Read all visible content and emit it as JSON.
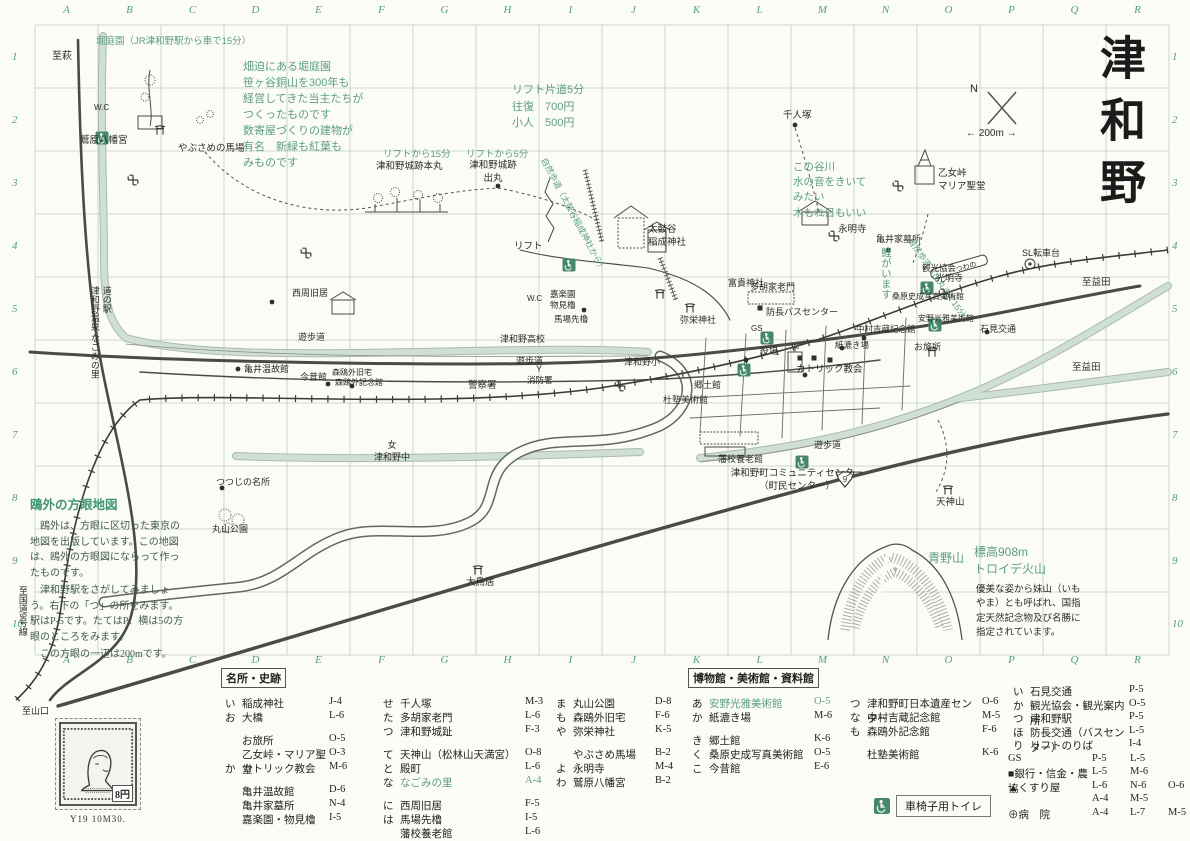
{
  "title": "津和野",
  "grid": {
    "columns": [
      "A",
      "B",
      "C",
      "D",
      "E",
      "F",
      "G",
      "H",
      "I",
      "J",
      "K",
      "L",
      "M",
      "N",
      "O",
      "P",
      "Q",
      "R"
    ],
    "rows": [
      "1",
      "2",
      "3",
      "4",
      "5",
      "6",
      "7",
      "8",
      "9",
      "10"
    ]
  },
  "colors": {
    "grid_green": "#53a07e",
    "annotation_green": "#5d9e7e",
    "river_green": "#cfe0d2",
    "ink": "#2b2b28"
  },
  "sidenote": {
    "title": "鴎外の方眼地図",
    "paragraphs": [
      "　鴎外は、方眼に区切った東京の地図を出版しています。この地図は、鴎外の方眼図にならって作ったものです。",
      "　津和野駅をさがしてみましょう。右下の「つ」の所をみます。駅はP-5です。たてはP、横は5の方眼のところをみます。",
      "　この方眼の一辺は200mです。"
    ]
  },
  "stamp": {
    "caption": "Y19 10M30.",
    "denomination": "8円"
  },
  "map": {
    "labels": [
      {
        "t": "至萩",
        "x": 52,
        "y": 50
      },
      {
        "t": "堀庭園（JR津和野駅から車で15分）",
        "x": 96,
        "y": 36,
        "c": "g",
        "s": 9.5
      },
      {
        "t": "畑迫にある堀庭園\n笹ヶ谷銅山を300年も\n経営してきた当主たちが\nつくったものです\n数寄屋づくりの建物が\n有名　新緑も紅葉も\nみものです",
        "x": 243,
        "y": 60,
        "c": "g",
        "s": 11,
        "lh": 1.45
      },
      {
        "t": "W.C",
        "x": 94,
        "y": 103,
        "s": 8
      },
      {
        "t": "鷲原八幡宮",
        "x": 80,
        "y": 135,
        "s": 9.5
      },
      {
        "t": "やぶさめの馬場",
        "x": 178,
        "y": 143,
        "s": 9.5
      },
      {
        "t": "リフトから15分",
        "x": 383,
        "y": 149,
        "c": "g",
        "s": 9.5
      },
      {
        "t": "津和野城跡本丸",
        "x": 376,
        "y": 161,
        "s": 9.5
      },
      {
        "t": "リフトから5分",
        "x": 466,
        "y": 149,
        "c": "g",
        "s": 9.5
      },
      {
        "t": "津和野城跡\n出丸",
        "x": 462,
        "y": 160,
        "s": 9.5,
        "w": 62
      },
      {
        "t": "リフト片道5分\n往復　700円\n小人　500円",
        "x": 512,
        "y": 82,
        "c": "g",
        "s": 11,
        "lh": 1.5
      },
      {
        "t": "自然歩道（太鼓谷稲成神社から）",
        "x": 548,
        "y": 156,
        "c": "g",
        "s": 8.5,
        "r": 62
      },
      {
        "t": "自然歩道（出丸まで15分）",
        "x": 914,
        "y": 236,
        "c": "g",
        "s": 8.5,
        "r": 55
      },
      {
        "t": "リフト",
        "x": 514,
        "y": 241,
        "s": 9.5
      },
      {
        "t": "太鼓谷\n稲成神社",
        "x": 648,
        "y": 224,
        "s": 9.5
      },
      {
        "t": "富貴神社",
        "x": 728,
        "y": 278,
        "s": 9
      },
      {
        "t": "多胡家老門",
        "x": 750,
        "y": 282,
        "s": 9
      },
      {
        "t": "千人塚",
        "x": 783,
        "y": 110,
        "s": 9.5
      },
      {
        "t": "この谷川\n水の音をきいて\nみたい\n木もれ日もいい",
        "x": 793,
        "y": 160,
        "c": "g",
        "s": 10.5,
        "lh": 1.45
      },
      {
        "t": "乙女峠\nマリア聖堂",
        "x": 938,
        "y": 168,
        "s": 9.5
      },
      {
        "t": "永明寺",
        "x": 838,
        "y": 224,
        "s": 9.5
      },
      {
        "t": "亀井家墓所",
        "x": 876,
        "y": 234,
        "s": 9
      },
      {
        "t": "光明寺",
        "x": 936,
        "y": 273,
        "s": 9
      },
      {
        "t": "SL転車台",
        "x": 1022,
        "y": 248,
        "s": 9
      },
      {
        "t": "至益田",
        "x": 1082,
        "y": 277,
        "s": 9.5
      },
      {
        "t": "至益田",
        "x": 1072,
        "y": 362,
        "s": 9.5
      },
      {
        "t": "N",
        "x": 970,
        "y": 82,
        "s": 11
      },
      {
        "t": "← 200m →",
        "x": 966,
        "y": 127,
        "s": 10
      },
      {
        "t": "観光協会",
        "x": 922,
        "y": 263,
        "s": 8.5
      },
      {
        "t": "桑原史成写真美術館",
        "x": 892,
        "y": 292,
        "s": 8
      },
      {
        "t": "安野光雅美術館",
        "x": 918,
        "y": 314,
        "s": 8
      },
      {
        "t": "石見交通",
        "x": 980,
        "y": 324,
        "s": 9
      },
      {
        "t": "お旅所",
        "x": 914,
        "y": 342,
        "s": 9
      },
      {
        "t": "防長バスセンター",
        "x": 766,
        "y": 307,
        "s": 9
      },
      {
        "t": "中村吉蔵記念館",
        "x": 856,
        "y": 324,
        "s": 8.5
      },
      {
        "t": "紙漉き場",
        "x": 835,
        "y": 340,
        "s": 8.5
      },
      {
        "t": "役場",
        "x": 760,
        "y": 346,
        "s": 9
      },
      {
        "t": "弥栄神社",
        "x": 680,
        "y": 315,
        "s": 9
      },
      {
        "t": "カトリック教会",
        "x": 796,
        "y": 364,
        "s": 9.5
      },
      {
        "t": "郷土館",
        "x": 694,
        "y": 380,
        "s": 9
      },
      {
        "t": "杜塾美術館",
        "x": 663,
        "y": 395,
        "s": 9
      },
      {
        "t": "津和野高校",
        "x": 500,
        "y": 334,
        "s": 9
      },
      {
        "t": "津和野小",
        "x": 624,
        "y": 357,
        "s": 9
      },
      {
        "t": "遊歩道",
        "x": 298,
        "y": 332,
        "s": 9
      },
      {
        "t": "遊歩道",
        "x": 516,
        "y": 356,
        "s": 9
      },
      {
        "t": "遊歩道",
        "x": 814,
        "y": 440,
        "s": 9
      },
      {
        "t": "西周旧居",
        "x": 292,
        "y": 288,
        "s": 9
      },
      {
        "t": "嘉楽園\n物見櫓",
        "x": 550,
        "y": 289,
        "s": 8.5
      },
      {
        "t": "馬場先櫓",
        "x": 554,
        "y": 314,
        "s": 8.5
      },
      {
        "t": "W.C",
        "x": 527,
        "y": 294,
        "s": 8
      },
      {
        "t": "亀井温故館",
        "x": 244,
        "y": 364,
        "s": 9
      },
      {
        "t": "今昔館",
        "x": 300,
        "y": 372,
        "s": 9
      },
      {
        "t": "森鴎外旧宅",
        "x": 332,
        "y": 368,
        "s": 8
      },
      {
        "t": "森鴎外記念館",
        "x": 335,
        "y": 378,
        "s": 8
      },
      {
        "t": "警察署",
        "x": 468,
        "y": 380,
        "s": 9.5
      },
      {
        "t": "Y",
        "x": 536,
        "y": 364,
        "s": 9
      },
      {
        "t": "消防署",
        "x": 527,
        "y": 375,
        "s": 8.5
      },
      {
        "t": "女\n津和野中",
        "x": 362,
        "y": 440,
        "s": 9,
        "w": 60
      },
      {
        "t": "津和野町コミュニティセンター\n（町民センター）",
        "x": 706,
        "y": 468,
        "s": 9.5,
        "w": 182
      },
      {
        "t": "藩校養老館",
        "x": 718,
        "y": 454,
        "s": 9
      },
      {
        "t": "天神山",
        "x": 936,
        "y": 497,
        "s": 9.5
      },
      {
        "t": "つつじの名所",
        "x": 216,
        "y": 477,
        "s": 9
      },
      {
        "t": "丸山公園",
        "x": 212,
        "y": 524,
        "s": 9
      },
      {
        "t": "大鳥居",
        "x": 466,
        "y": 577,
        "s": 9.5
      },
      {
        "t": "鯉がいます",
        "x": 878,
        "y": 247,
        "c": "g",
        "s": 10.5,
        "v": 1
      },
      {
        "t": "青野山",
        "x": 928,
        "y": 551,
        "c": "g",
        "s": 12
      },
      {
        "t": "標高908m\nトロイデ火山",
        "x": 974,
        "y": 544,
        "c": "g",
        "s": 12,
        "lh": 1.4
      },
      {
        "t": "優美な姿から妹山（いも\nやま）とも呼ばれ、国指\n定天然記念物及び名勝に\n指定されています。",
        "x": 976,
        "y": 583,
        "s": 9.5,
        "lh": 1.5
      },
      {
        "t": "道の駅\n津和野温泉 なごみの里",
        "x": 88,
        "y": 286,
        "s": 9,
        "v": 1
      },
      {
        "t": "至国道9号線",
        "x": 16,
        "y": 586,
        "s": 9,
        "v": 1
      },
      {
        "t": "至山口",
        "x": 22,
        "y": 706,
        "s": 9
      },
      {
        "t": "GS",
        "x": 751,
        "y": 324,
        "s": 8
      },
      {
        "t": "つわの",
        "x": 955,
        "y": 266,
        "s": 7,
        "r": -16
      }
    ],
    "symbols": [
      {
        "t": "p",
        "x": 178,
        "y": 336
      },
      {
        "t": "p",
        "x": 350,
        "y": 394
      },
      {
        "t": "p",
        "x": 610,
        "y": 252
      },
      {
        "t": "p",
        "x": 646,
        "y": 306
      },
      {
        "t": "p",
        "x": 738,
        "y": 320
      },
      {
        "t": "p",
        "x": 744,
        "y": 337
      },
      {
        "t": "p",
        "x": 928,
        "y": 249
      },
      {
        "t": "p",
        "x": 604,
        "y": 300
      },
      {
        "t": "dot",
        "x": 795,
        "y": 125
      },
      {
        "t": "dot",
        "x": 888,
        "y": 250
      },
      {
        "t": "dot",
        "x": 498,
        "y": 186
      },
      {
        "t": "dot",
        "x": 272,
        "y": 302
      },
      {
        "t": "dot",
        "x": 584,
        "y": 310
      },
      {
        "t": "dot",
        "x": 238,
        "y": 369
      },
      {
        "t": "dot",
        "x": 328,
        "y": 384
      },
      {
        "t": "dot",
        "x": 864,
        "y": 338
      },
      {
        "t": "dot",
        "x": 842,
        "y": 348
      },
      {
        "t": "dot",
        "x": 987,
        "y": 332
      },
      {
        "t": "dot",
        "x": 352,
        "y": 386
      },
      {
        "t": "dot",
        "x": 805,
        "y": 375
      },
      {
        "t": "dot",
        "x": 746,
        "y": 360
      },
      {
        "t": "dot",
        "x": 222,
        "y": 488
      },
      {
        "t": "manji",
        "x": 133,
        "y": 180
      },
      {
        "t": "manji",
        "x": 620,
        "y": 386
      },
      {
        "t": "manji",
        "x": 834,
        "y": 236
      },
      {
        "t": "manji",
        "x": 898,
        "y": 186
      },
      {
        "t": "manji",
        "x": 944,
        "y": 294
      },
      {
        "t": "manji",
        "x": 306,
        "y": 253
      },
      {
        "t": "torii",
        "x": 690,
        "y": 308
      },
      {
        "t": "torii",
        "x": 932,
        "y": 352
      },
      {
        "t": "torii",
        "x": 948,
        "y": 490
      },
      {
        "t": "torii",
        "x": 478,
        "y": 570
      },
      {
        "t": "torii",
        "x": 660,
        "y": 294
      },
      {
        "t": "torii",
        "x": 160,
        "y": 130
      },
      {
        "t": "hosp",
        "x": 81,
        "y": 268
      },
      {
        "t": "hosp",
        "x": 848,
        "y": 318
      },
      {
        "t": "hosp",
        "x": 773,
        "y": 430
      },
      {
        "t": "pol",
        "x": 460,
        "y": 384
      },
      {
        "t": "sq",
        "x": 800,
        "y": 358
      },
      {
        "t": "sq",
        "x": 814,
        "y": 358
      },
      {
        "t": "sq",
        "x": 760,
        "y": 308
      },
      {
        "t": "sq",
        "x": 830,
        "y": 360
      },
      {
        "t": "tri",
        "x": 66,
        "y": 246
      },
      {
        "t": "tri",
        "x": 764,
        "y": 368
      },
      {
        "t": "tri",
        "x": 888,
        "y": 368
      },
      {
        "t": "tri",
        "x": 950,
        "y": 368
      },
      {
        "t": "tri",
        "x": 826,
        "y": 308
      },
      {
        "t": "wc",
        "x": 102,
        "y": 138
      },
      {
        "t": "wc",
        "x": 569,
        "y": 265
      },
      {
        "t": "wc",
        "x": 767,
        "y": 338
      },
      {
        "t": "wc",
        "x": 744,
        "y": 370
      },
      {
        "t": "wc",
        "x": 802,
        "y": 462
      },
      {
        "t": "wc",
        "x": 927,
        "y": 288
      },
      {
        "t": "wc",
        "x": 935,
        "y": 325
      }
    ],
    "route_shield": "9"
  },
  "legend": {
    "wheelchair_note": "車椅子用トイレ",
    "columns": [
      {
        "x": 225,
        "w": 140,
        "header": "名所・史跡",
        "rows": [
          {
            "k": "い",
            "n": "稲成神社",
            "c": "J-4"
          },
          {
            "k": "お",
            "n": "大橋",
            "c": "L-6"
          },
          {
            "sp": 1
          },
          {
            "k": "",
            "n": "お旅所",
            "c": "O-5"
          },
          {
            "k": "",
            "n": "乙女峠・マリア聖堂",
            "c": "O-3"
          },
          {
            "k": "か",
            "n": "カトリック教会",
            "c": "M-6"
          },
          {
            "sp": 1
          },
          {
            "k": "",
            "n": "亀井温故館",
            "c": "D-6"
          },
          {
            "k": "",
            "n": "亀井家墓所",
            "c": "N-4"
          },
          {
            "k": "",
            "n": "嘉楽園・物見櫓",
            "c": "I-5"
          }
        ]
      },
      {
        "x": 383,
        "w": 178,
        "rows": [
          {
            "k": "せ",
            "n": "千人塚",
            "c": "M-3"
          },
          {
            "k": "た",
            "n": "多胡家老門",
            "c": "L-6"
          },
          {
            "k": "つ",
            "n": "津和野城趾",
            "c": "F-3"
          },
          {
            "sp": 1
          },
          {
            "k": "て",
            "n": "天神山（松林山天満宮）",
            "c": "O-8"
          },
          {
            "k": "と",
            "n": "殿町",
            "c": "L-6"
          },
          {
            "k": "な",
            "n": "なごみの里",
            "c": "A-4",
            "g": 1
          },
          {
            "sp": 1
          },
          {
            "k": "に",
            "n": "西周旧居",
            "c": "F-5"
          },
          {
            "k": "は",
            "n": "馬場先櫓",
            "c": "I-5"
          },
          {
            "k": "",
            "n": "藩校養老館",
            "c": "L-6"
          }
        ]
      },
      {
        "x": 556,
        "w": 135,
        "rows": [
          {
            "k": "ま",
            "n": "丸山公園",
            "c": "D-8"
          },
          {
            "k": "も",
            "n": "森鴎外旧宅",
            "c": "F-6"
          },
          {
            "k": "や",
            "n": "弥栄神社",
            "c": "K-5"
          },
          {
            "sp": 1
          },
          {
            "k": "",
            "n": "やぶさめ馬場",
            "c": "B-2"
          },
          {
            "k": "よ",
            "n": "永明寺",
            "c": "M-4"
          },
          {
            "k": "わ",
            "n": "鷲原八幡宮",
            "c": "B-2"
          }
        ]
      },
      {
        "x": 692,
        "w": 158,
        "header": "博物館・美術館・資料館",
        "rows": [
          {
            "k": "あ",
            "n": "安野光雅美術館",
            "c": "O-5",
            "g": 1
          },
          {
            "k": "か",
            "n": "紙漉き場",
            "c": "M-6"
          },
          {
            "sp": 1
          },
          {
            "k": "き",
            "n": "郷土館",
            "c": "K-6"
          },
          {
            "k": "く",
            "n": "桑原史成写真美術館",
            "c": "O-5"
          },
          {
            "k": "こ",
            "n": "今昔館",
            "c": "E-6"
          }
        ]
      },
      {
        "x": 850,
        "w": 168,
        "rows": [
          {
            "k": "つ",
            "n": "津和野町日本遺産センター",
            "c": "O-6"
          },
          {
            "k": "な",
            "n": "中村吉蔵記念館",
            "c": "M-5"
          },
          {
            "k": "も",
            "n": "森鴎外記念館",
            "c": "F-6"
          },
          {
            "sp": 1
          },
          {
            "k": "",
            "n": "杜塾美術館",
            "c": "K-6"
          }
        ]
      },
      {
        "x": 1013,
        "w": 152,
        "y0": 684,
        "rh": 13.5,
        "rows": [
          {
            "k": "い",
            "n": "石見交通",
            "c": "P-5"
          },
          {
            "k": "か",
            "n": "観光協会・観光案内所",
            "c": "O-5"
          },
          {
            "k": "つ",
            "n": "津和野駅",
            "c": "P-5"
          },
          {
            "k": "ほ",
            "n": "防長交通（バスセンター）",
            "c": "L-5"
          },
          {
            "k": "り",
            "n": "リフトのりば",
            "c": "I-4"
          }
        ]
      }
    ],
    "facilities": [
      {
        "sym": "",
        "label": "GS",
        "coords": [
          "P-5",
          "L-5"
        ]
      },
      {
        "sym": "■",
        "label": "銀行・信金・農協",
        "coords": [
          "L-5",
          "M-6"
        ]
      },
      {
        "sym": "▲",
        "label": "くすり屋",
        "coords": [
          "L-6",
          "N-6",
          "O-6"
        ]
      },
      {
        "sym": "",
        "label": "",
        "coords": [
          "A-4",
          "M-5"
        ]
      },
      {
        "sym": "⊕",
        "label": "病　院",
        "coords": [
          "A-4",
          "L-7",
          "M-5"
        ]
      }
    ]
  }
}
